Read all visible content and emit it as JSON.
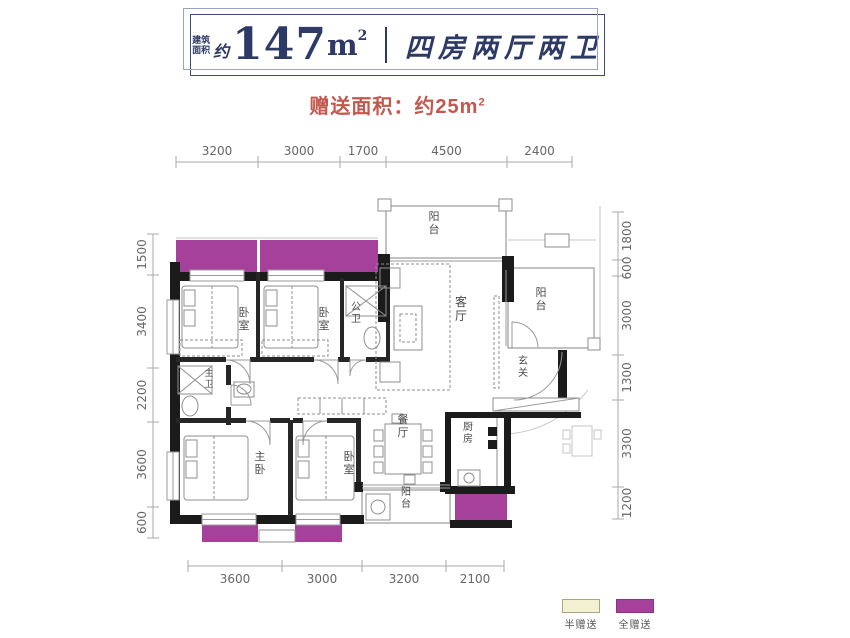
{
  "colors": {
    "navy": "#2e3a66",
    "accent_red": "#c2584e",
    "gift_full": "#a5419a",
    "gift_full_border": "#8b3180",
    "gift_half": "#f4f1d3",
    "gift_half_border": "#a9a57d",
    "wall": "#1b1b1b"
  },
  "header": {
    "area_label_line1": "建筑",
    "area_label_line2": "面积",
    "approx": "约",
    "area_value": "147",
    "area_unit": "m",
    "area_sup": "2",
    "layout_title": "四房两厅两卫"
  },
  "subtitle": {
    "label": "赠送面积：约25m",
    "sup": "2"
  },
  "legend": {
    "items": [
      {
        "name": "half-gift",
        "label": "半赠送",
        "color": "#f4f1d3",
        "border": "#a9a57d"
      },
      {
        "name": "full-gift",
        "label": "全赠送",
        "color": "#a5419a",
        "border": "#8b3180"
      }
    ]
  },
  "dimensions": {
    "top": {
      "orientation": "h",
      "line": 162,
      "label_dy": -7,
      "ticks": [
        176,
        258,
        340,
        386,
        507,
        572
      ],
      "values": [
        "3200",
        "3000",
        "1700",
        "4500",
        "2400"
      ]
    },
    "bottom": {
      "orientation": "h",
      "line": 566,
      "label_dy": 17,
      "ticks": [
        188,
        282,
        362,
        446,
        504
      ],
      "values": [
        "3600",
        "3000",
        "3200",
        "2100"
      ]
    },
    "left": {
      "orientation": "v",
      "line": 153,
      "label_dx": -7,
      "ticks": [
        234,
        275,
        368,
        422,
        507,
        538
      ],
      "values": [
        "1500",
        "3400",
        "2200",
        "3600",
        "600"
      ]
    },
    "right": {
      "orientation": "v",
      "line": 618,
      "label_dx": 13,
      "ticks": [
        212,
        260,
        276,
        355,
        400,
        487,
        519
      ],
      "values": [
        "1800",
        "600",
        "3000",
        "1300",
        "3300",
        "1200"
      ]
    }
  },
  "rooms": [
    {
      "name": "balcony-top",
      "label": "阳台",
      "x": 434,
      "y": 220,
      "size": 11
    },
    {
      "name": "living-room",
      "label": "客厅",
      "x": 461,
      "y": 306,
      "size": 12
    },
    {
      "name": "balcony-right",
      "label": "阳台",
      "x": 541,
      "y": 296,
      "size": 11
    },
    {
      "name": "foyer",
      "label": "玄关",
      "x": 523,
      "y": 364,
      "size": 10
    },
    {
      "name": "bedroom-1",
      "label": "卧室",
      "x": 244,
      "y": 316,
      "size": 11
    },
    {
      "name": "bedroom-2",
      "label": "卧室",
      "x": 324,
      "y": 316,
      "size": 11
    },
    {
      "name": "public-bath",
      "label": "公卫",
      "x": 356,
      "y": 310,
      "size": 10
    },
    {
      "name": "master-bath",
      "label": "主卫",
      "x": 209,
      "y": 376,
      "size": 9
    },
    {
      "name": "master-bedroom",
      "label": "主卧",
      "x": 260,
      "y": 460,
      "size": 11
    },
    {
      "name": "bedroom-3",
      "label": "卧室",
      "x": 349,
      "y": 460,
      "size": 11
    },
    {
      "name": "dining-room",
      "label": "餐厅",
      "x": 403,
      "y": 423,
      "size": 11
    },
    {
      "name": "kitchen",
      "label": "厨房",
      "x": 468,
      "y": 430,
      "size": 10
    },
    {
      "name": "balcony-bottom",
      "label": "阳台",
      "x": 406,
      "y": 495,
      "size": 10
    }
  ]
}
